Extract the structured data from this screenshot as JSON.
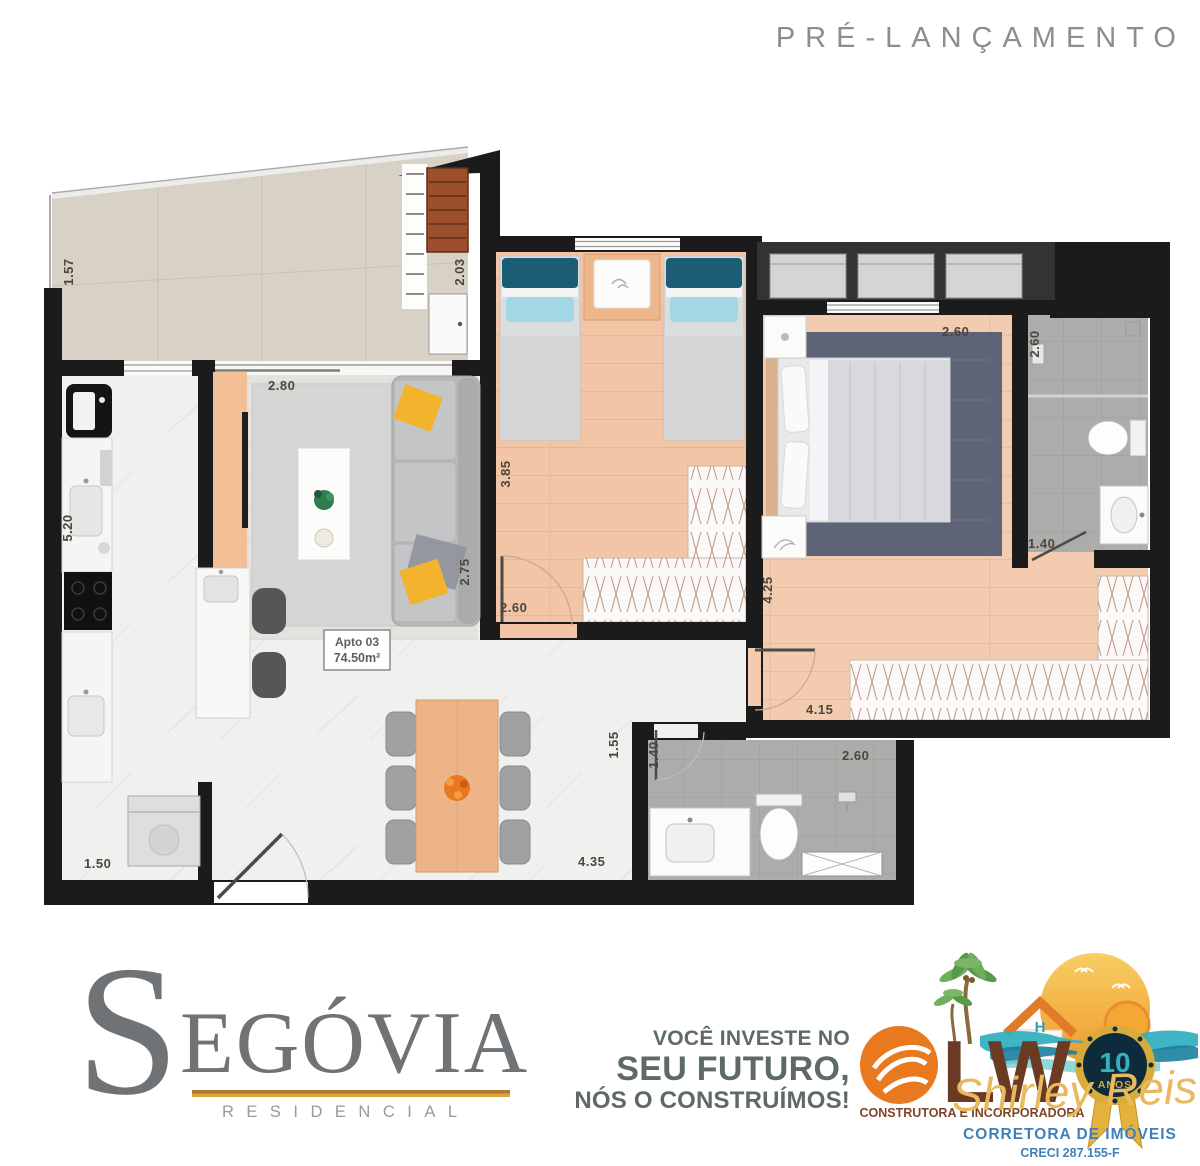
{
  "header": {
    "pre_launch": "PRÉ-LANÇAMENTO"
  },
  "floorplan": {
    "unit": {
      "name": "Apto 03",
      "area": "74.50m²"
    },
    "dims": {
      "balcony_depth": "1.57",
      "grill_width": "2.03",
      "living_width": "2.80",
      "kitchen_length": "5.20",
      "living_depth": "2.75",
      "service_width": "1.50",
      "bedroom2_length": "3.85",
      "bedroom2_width": "2.60",
      "master_width": "2.60",
      "master_length": "4.25",
      "master_closet_length": "4.15",
      "bath1_length": "2.60",
      "bath1_width": "1.40",
      "hall_width": "1.55",
      "bath2_width": "1.40",
      "bath2_length": "2.60",
      "dining_width": "4.35"
    }
  },
  "footer": {
    "segovia": {
      "initial": "S",
      "name_rest": "EGÓVIA",
      "subtitle": "RESIDENCIAL"
    },
    "slogan": {
      "line1": "VOCÊ INVESTE NO",
      "line2": "SEU FUTURO,",
      "line3": "NÓS O CONSTRUÍMOS!"
    },
    "lwo": {
      "monogram": "LW",
      "house_letter": "H",
      "tagline": "CONSTRUTORA E INCORPORADORA",
      "badge_number": "10",
      "badge_label": "ANOS",
      "broker_script": "Shirley Reis",
      "broker_title": "CORRETORA DE IMÓVEIS",
      "creci": "CRECI 287.155-F"
    }
  },
  "colors": {
    "wall": "#1b1b1b",
    "bedroom_floor": "#f1c5a6",
    "balcony_floor": "#d8d2c6",
    "bath_floor": "#acacaa",
    "accent_yellow_pillow": "#f3b42d",
    "segovia_gray": "#6f7376",
    "underline_orange": "#b5762f",
    "slogan_green": "#5e6b63",
    "lwo_orange": "#e8791f",
    "lwo_brown": "#6a3a23",
    "broker_blue": "#3f80b8",
    "script_gold": "#eab95e"
  }
}
